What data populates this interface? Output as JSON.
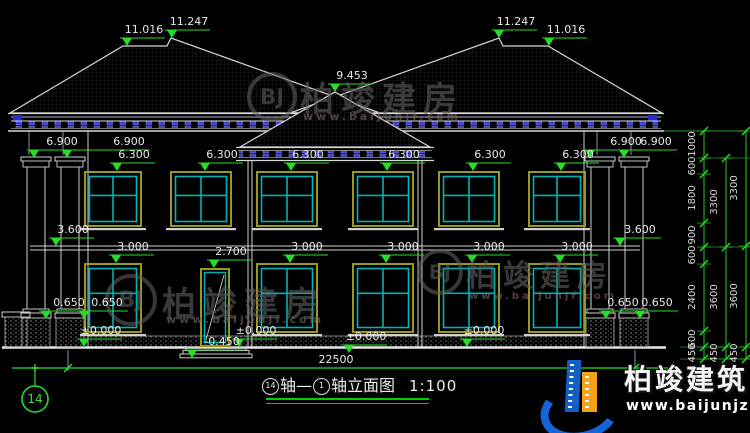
{
  "drawing": {
    "title": {
      "axis_start": "14",
      "mid": "轴—",
      "axis_end": "1",
      "suffix": "轴立面图",
      "scale": "1:100"
    },
    "axis_bubble": "14",
    "width_dim": "22500",
    "elevation_markers": [
      {
        "t": "11.016",
        "x": 127,
        "y": 46
      },
      {
        "t": "11.247",
        "x": 172,
        "y": 38
      },
      {
        "t": "9.453",
        "x": 335,
        "y": 92
      },
      {
        "t": "11.247",
        "x": 499,
        "y": 38
      },
      {
        "t": "11.016",
        "x": 549,
        "y": 46
      },
      {
        "t": "6.900",
        "x": 34,
        "y": 158,
        "dx": 11
      },
      {
        "t": "6.900",
        "x": 67,
        "y": 158,
        "dx": 45
      },
      {
        "t": "6.900",
        "x": 590,
        "y": 158,
        "dx": 19
      },
      {
        "t": "6.900",
        "x": 624,
        "y": 158,
        "dx": 15
      },
      {
        "t": "6.300",
        "x": 117,
        "y": 171
      },
      {
        "t": "6.300",
        "x": 205,
        "y": 171
      },
      {
        "t": "6.300",
        "x": 291,
        "y": 171
      },
      {
        "t": "6.300",
        "x": 387,
        "y": 171
      },
      {
        "t": "6.300",
        "x": 473,
        "y": 171
      },
      {
        "t": "6.300",
        "x": 561,
        "y": 171
      },
      {
        "t": "3.600",
        "x": 56,
        "y": 246
      },
      {
        "t": "3.600",
        "x": 620,
        "y": 246,
        "dx": 3
      },
      {
        "t": "3.000",
        "x": 116,
        "y": 263
      },
      {
        "t": "3.000",
        "x": 290,
        "y": 263
      },
      {
        "t": "3.000",
        "x": 386,
        "y": 263
      },
      {
        "t": "3.000",
        "x": 472,
        "y": 263
      },
      {
        "t": "3.000",
        "x": 560,
        "y": 263
      },
      {
        "t": "2.700",
        "x": 214,
        "y": 268
      },
      {
        "t": "0.650",
        "x": 46,
        "y": 319,
        "dx": 6
      },
      {
        "t": "0.650",
        "x": 84,
        "y": 319,
        "dx": 6
      },
      {
        "t": "0.650",
        "x": 606,
        "y": 319
      },
      {
        "t": "0.650",
        "x": 640,
        "y": 319
      },
      {
        "t": "±0.000",
        "x": 84,
        "y": 347
      },
      {
        "t": "±0.000",
        "x": 239,
        "y": 347
      },
      {
        "t": "±0.000",
        "x": 467,
        "y": 347
      },
      {
        "t": "±0.000",
        "x": 349,
        "y": 353
      },
      {
        "t": "-0.450",
        "x": 192,
        "y": 358,
        "dx": 13
      }
    ],
    "dim_chains": [
      {
        "x": 704,
        "ticks": [
          131,
          158,
          174,
          223,
          247,
          264,
          331,
          347,
          359
        ],
        "labels": [
          {
            "t": "1000",
            "y": 144
          },
          {
            "t": "600",
            "y": 166
          },
          {
            "t": "1800",
            "y": 198
          },
          {
            "t": "900",
            "y": 235
          },
          {
            "t": "600",
            "y": 255
          },
          {
            "t": "2400",
            "y": 297
          },
          {
            "t": "600",
            "y": 339
          },
          {
            "t": "450",
            "y": 353
          }
        ]
      },
      {
        "x": 726,
        "ticks": [
          158,
          247,
          347,
          359
        ],
        "labels": [
          {
            "t": "3300",
            "y": 202
          },
          {
            "t": "3600",
            "y": 297
          },
          {
            "t": "450",
            "y": 353
          }
        ]
      },
      {
        "x": 746,
        "ticks": [
          131,
          246,
          347,
          359
        ],
        "labels": [
          {
            "t": "3300",
            "y": 188
          },
          {
            "t": "3600",
            "y": 296
          },
          {
            "t": "450",
            "y": 353
          }
        ]
      }
    ]
  },
  "watermark": {
    "name": "柏竣建房",
    "url": "www.baijunjf.com",
    "monogram": "BJ",
    "instances": [
      {
        "cx": 272,
        "cy": 97,
        "r": 25,
        "tx": 300,
        "ty": 72,
        "fs": 34,
        "ux": 303,
        "uy": 110
      },
      {
        "cx": 131,
        "cy": 300,
        "r": 26,
        "tx": 162,
        "ty": 277,
        "fs": 34,
        "ux": 166,
        "uy": 313
      },
      {
        "cx": 440,
        "cy": 272,
        "r": 23,
        "tx": 466,
        "ty": 251,
        "fs": 30,
        "ux": 469,
        "uy": 291
      }
    ]
  },
  "brand": {
    "name": "柏竣建筑",
    "url": "www.baijunjz.com"
  },
  "colors": {
    "line": "#d8d8d8",
    "dim_green": "#27dd27",
    "window_teal": "#00b2b2",
    "frame_olive": "#9a9a14",
    "dentil_blue": "#3c3cd8"
  }
}
